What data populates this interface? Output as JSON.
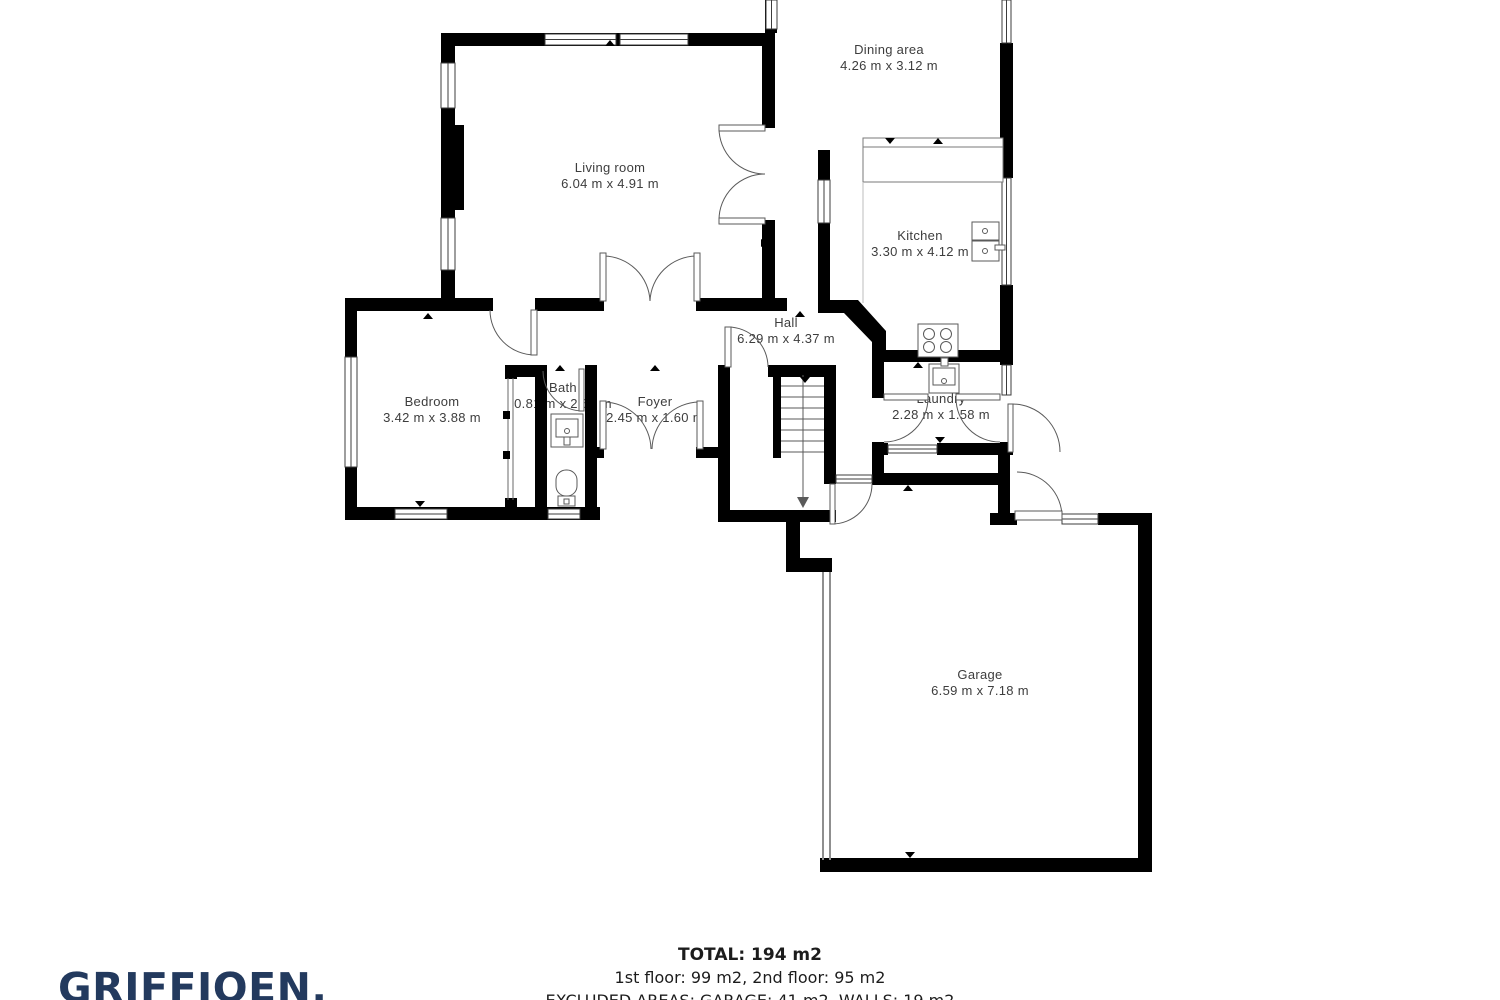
{
  "rooms": {
    "living_room": {
      "name": "Living room",
      "dims": "6.04 m x 4.91 m"
    },
    "dining": {
      "name": "Dining area",
      "dims": "4.26 m x 3.12 m"
    },
    "kitchen": {
      "name": "Kitchen",
      "dims": "3.30 m x 4.12 m"
    },
    "hall": {
      "name": "Hall",
      "dims": "6.29 m x 4.37 m"
    },
    "bedroom": {
      "name": "Bedroom",
      "dims": "3.42 m x 3.88 m"
    },
    "bath": {
      "name": "Bath",
      "dims": "0.81 m x 2.60 m"
    },
    "foyer": {
      "name": "Foyer",
      "dims": "2.45 m x 1.60 m"
    },
    "laundry": {
      "name": "Laundry",
      "dims": "2.28 m x 1.58 m"
    },
    "garage": {
      "name": "Garage",
      "dims": "6.59 m x 7.18 m"
    }
  },
  "footer": {
    "total": "TOTAL: 194 m2",
    "floors": "1st floor: 99 m2, 2nd floor: 95 m2",
    "excluded": "EXCLUDED AREAS: GARAGE: 41 m2, WALLS: 19 m2"
  },
  "branding": {
    "logo_text": "GRIFFIOEN.",
    "logo_color": "#233a5e"
  },
  "colors": {
    "wall": "#000000",
    "label_text": "#3d3d3d",
    "footer_text": "#1c1c1c",
    "door_line": "#5a5a5a",
    "garage_door_line": "#8f8f8f"
  }
}
